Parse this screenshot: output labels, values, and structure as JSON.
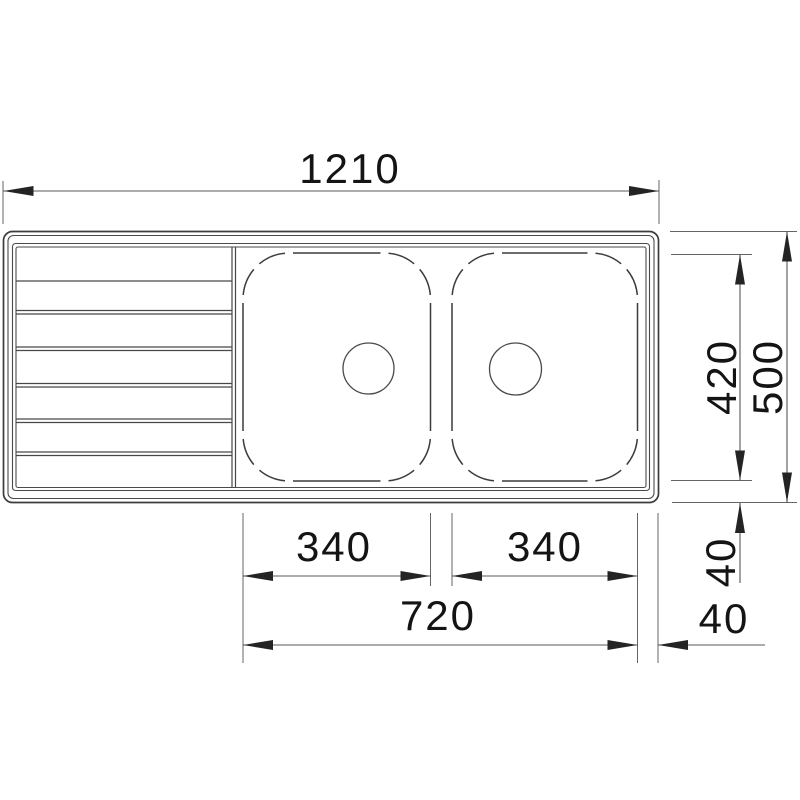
{
  "diagram": {
    "view": "sink-plan-top-view",
    "dimensions": {
      "overall_width": "1210",
      "overall_depth": "500",
      "bowl_depth": "420",
      "bowl_left_width": "340",
      "bowl_right_width": "340",
      "bowls_overall_width": "720",
      "edge_offset_bottom": "40",
      "edge_offset_right": "40"
    },
    "colors": {
      "background": "#ffffff",
      "outline": "#3c3c3c",
      "dimension_line": "#585858",
      "text": "#141414"
    }
  }
}
